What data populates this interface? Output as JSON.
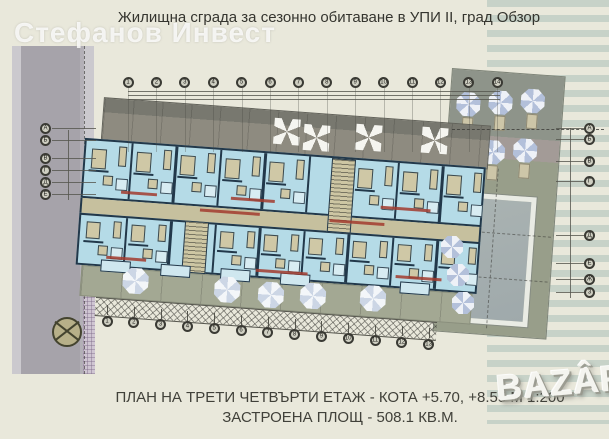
{
  "title": "Жилищна сграда за сезонно обитаване в УПИ II, град Обзор",
  "watermarks": {
    "top_left": "Стефанов Инвест",
    "bottom_right": "BAZÂR"
  },
  "caption": {
    "line1": "ПЛАН НА ТРЕТИ ЧЕТВЪРТИ ЕТАЖ - КОТА +5.70, +8.55 М 1:200",
    "line2": "ЗАСТРОЕНА ПЛОЩ - 508.1 КВ.М."
  },
  "plan": {
    "axes": {
      "top": [
        "1",
        "2",
        "3",
        "4",
        "5",
        "6",
        "7",
        "8",
        "9",
        "10",
        "11",
        "12",
        "13",
        "14"
      ],
      "bottom": [
        "1",
        "2",
        "3",
        "4",
        "5",
        "6",
        "7",
        "8",
        "9",
        "10",
        "11",
        "12",
        "13"
      ],
      "left": [
        "А",
        "Б",
        "В",
        "Г",
        "Д",
        "Е"
      ],
      "right": [
        "А",
        "Б",
        "В",
        "Г",
        "Д",
        "Е",
        "Ж",
        "З"
      ]
    }
  },
  "colors": {
    "background": "#e9e8db",
    "stripe": "#c7d2c8",
    "road": "#a6a3aa",
    "wall": "#22384a",
    "apartment_floor": "#b5dbe7",
    "furniture": "#cfc8a6",
    "roof_terrace": "#8e8b80",
    "ground_terrace": "#a3a893",
    "corridor": "#c6c09e",
    "pool_deck": "#989e8a",
    "pool_water": "#9fa9ab",
    "label_red": "#a23b2e"
  }
}
